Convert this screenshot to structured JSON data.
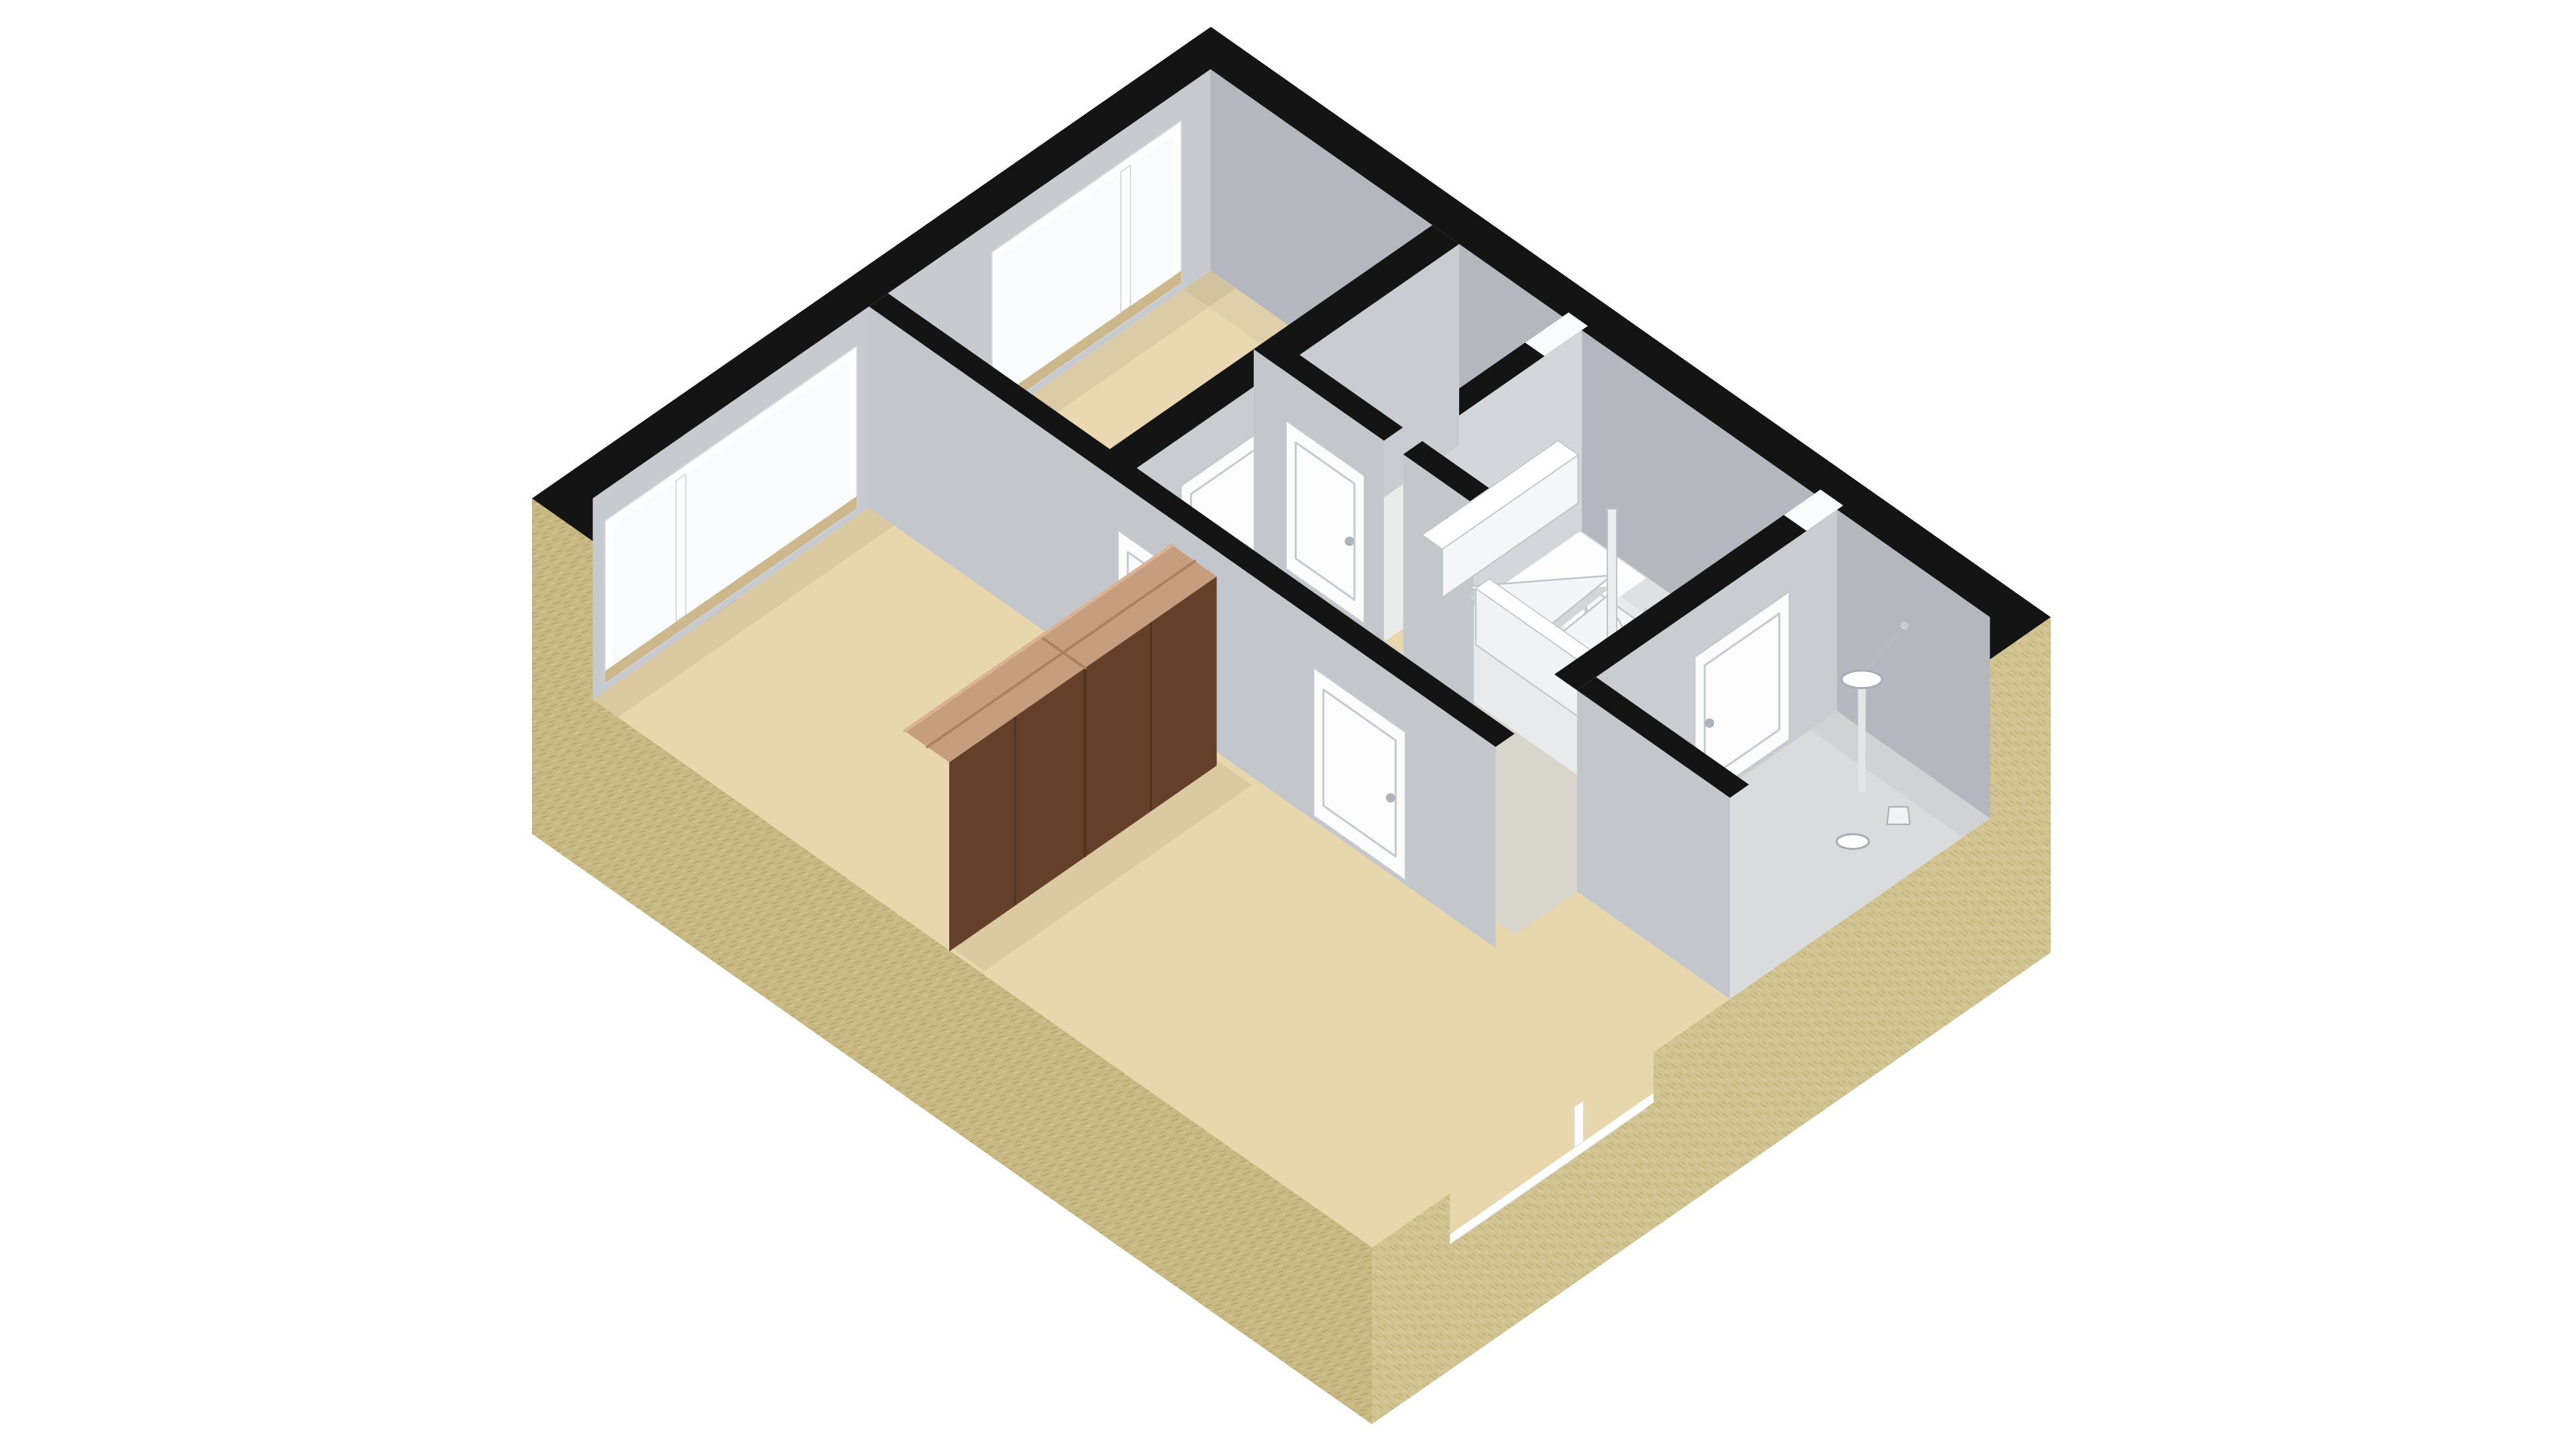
{
  "scene": {
    "type": "3d-floorplan-isometric-render",
    "background": "#ffffff",
    "floor_label": "upper-floor",
    "elements": [
      "exterior-walls",
      "wall-top-outline",
      "bedroom-left",
      "bedroom-top",
      "bedroom-front",
      "hallway",
      "closet",
      "stairwell",
      "spiral-staircase",
      "bathroom",
      "wardrobe-divider",
      "nw-window-large",
      "nw-window-small",
      "se-window-front",
      "se-window-bathroom",
      "door-bedroom-top",
      "door-bedroom-left",
      "door-bedroom-front",
      "door-closet",
      "door-bathroom",
      "bathroom-sink",
      "bathroom-toilet"
    ]
  },
  "colors": {
    "background": "#ffffff",
    "band_black": "#141414",
    "sand_se": "#d2c492",
    "sand_sw": "#c8b984",
    "sand_fiber_dark": "#c0b075",
    "sand_fiber_light": "#ddd1a4",
    "floor_bedroom": "#e8d6ac",
    "floor_bedroom_top": "#e9d8b1",
    "floor_hall": "#d8d5cc",
    "floor_closet": "#ebebec",
    "floor_stairwell": "#e9eaeb",
    "floor_bath": "#d9dbdd",
    "wall_nw_inner": "#c7cbd0",
    "wall_ne_inner": "#b4b8be",
    "wall_face_se": "#c9cdd2",
    "wall_face_sw": "#c3c7cc",
    "wall_face_light": "#d3d6da",
    "white_cap": "#fafbfc",
    "window_frame": "#ffffff",
    "window_frame_edge": "#d7dadd",
    "window_glass": "#fafbfd",
    "window_sill": "#cdb88e",
    "door_fill": "#fcfcfd",
    "door_edge": "#c6c9cd",
    "door_handle": "#aeb3b8",
    "stair_tread": "#f4f5f6",
    "stair_riser": "#d3d6d9",
    "stair_edge": "#c0c4c8",
    "stair_newel": "#eceef0",
    "balustrade": "#f1f2f3",
    "lightwell": "#fdfdfe",
    "wardrobe_front": "#64402a",
    "wardrobe_seam": "#4e311f",
    "wardrobe_top": "#c79d7f",
    "wardrobe_top_seam": "#ab8166",
    "wardrobe_top_hi": "#d9b394",
    "fixture_white": "#ffffff",
    "fixture_edge": "#a7adb3",
    "pedestal": "#e3e6e8",
    "shadow": "rgba(0,0,0,0.06)"
  }
}
